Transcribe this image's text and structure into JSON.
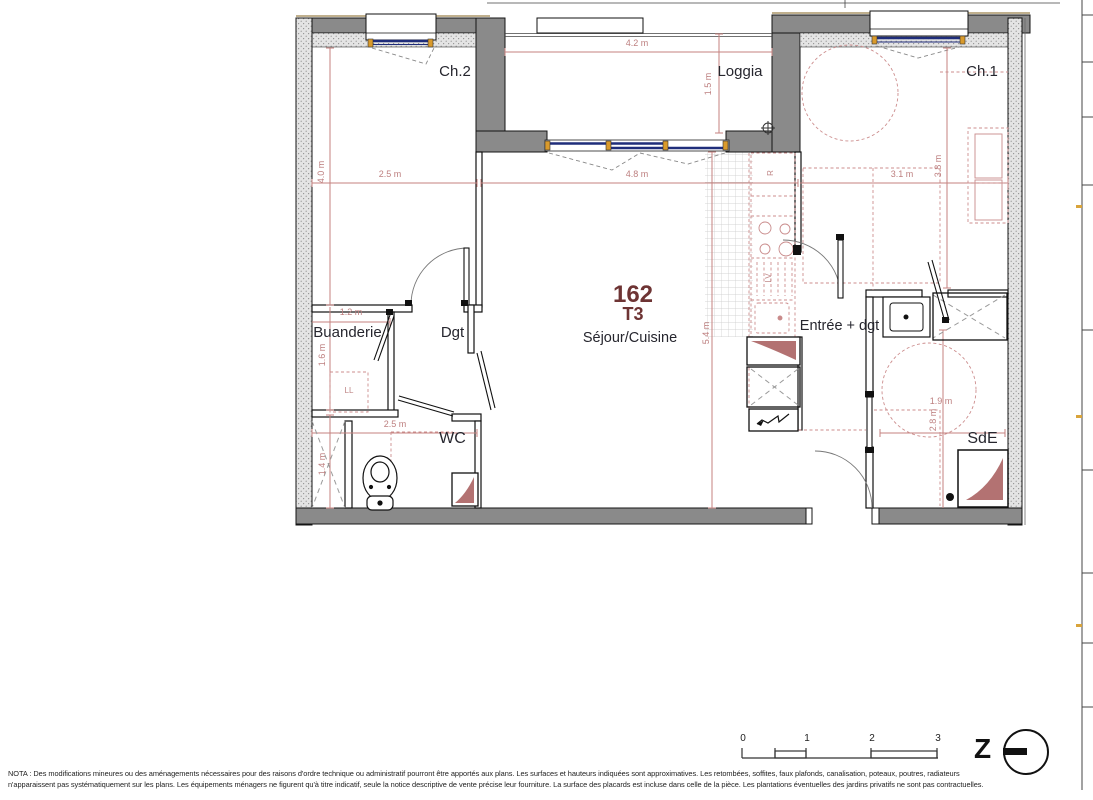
{
  "plan": {
    "unit": {
      "number": "162",
      "type": "T3"
    },
    "room_labels": {
      "ch2": "Ch.2",
      "loggia": "Loggia",
      "ch1": "Ch.1",
      "buanderie": "Buanderie",
      "dgt": "Dgt",
      "sejour_cuisine": "Séjour/Cuisine",
      "entree": "Entrée + dgt",
      "wc": "WC",
      "sde": "SdE"
    },
    "appliance_labels": {
      "washing_machine": "LL",
      "fridge": "R",
      "dishwasher": "LV"
    },
    "dimensions": {
      "ch2_width": "2.5 m",
      "ch2_depth": "4.0 m",
      "loggia_width": "4.2 m",
      "loggia_depth": "1.5 m",
      "sejour_width": "4.8 m",
      "sejour_depth": "5.4 m",
      "ch1_width": "3.1 m",
      "ch1_depth": "3.8 m",
      "buanderie_width": "1.2 m",
      "buanderie_depth": "1.6 m",
      "wc_width": "2.5 m",
      "wc_depth": "1.4 m",
      "sde_width": "1.9 m",
      "sde_depth": "2.8 m"
    },
    "scale_bar": {
      "ticks": [
        "0",
        "1",
        "2",
        "3"
      ]
    },
    "north_letter": "Z"
  },
  "footer": {
    "line1": "NOTA : Des modifications mineures ou des aménagements nécessaires pour des raisons d'ordre technique ou administratif pourront être apportés aux plans. Les surfaces et hauteurs indiquées sont approximatives. Les retombées, soffites, faux plafonds, canalisation, poteaux, poutres, radiateurs",
    "line2": "n'apparaissent pas systématiquement sur les plans.  Les équipements ménagers ne figurent qu'à titre indicatif, seule la notice descriptive de vente précise leur fourniture. La surface des placards est incluse dans celle de la pièce. Les plantations éventuelles des jardins privatifs ne sont pas contractuelles."
  },
  "colors": {
    "wall": "#8a8a8a",
    "dimension": "#bd7f7f",
    "unit_number": "#6e3434",
    "glazing": "#1f2d7a",
    "placard_triangle": "#b37272",
    "room_label": "#26262e"
  }
}
